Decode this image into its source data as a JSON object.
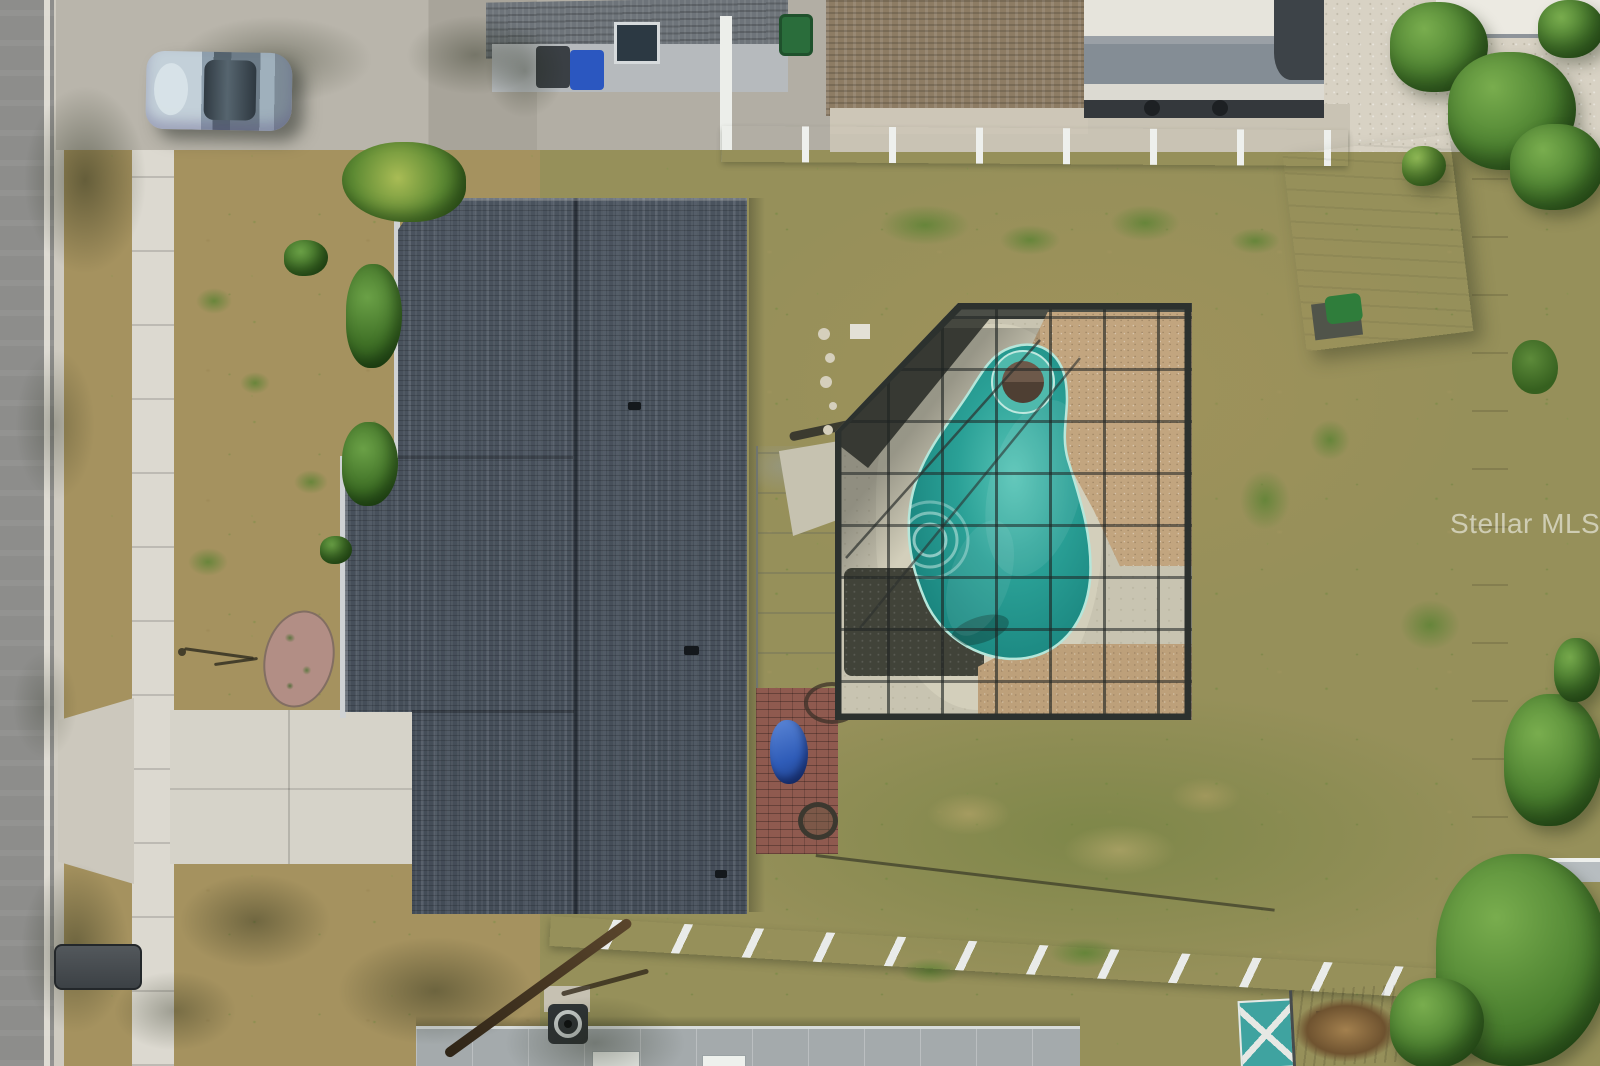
{
  "watermark": {
    "text": "Stellar MLS"
  },
  "palette": {
    "road": "#8d8d8b",
    "sidewalk": "#dcd9d0",
    "driveway": "#d6d3c9",
    "gravel": "#d8d2c4",
    "front_grass": "#a5925f",
    "back_grass": "#96905a",
    "roof_dark": "#47505b",
    "roof_brown": "#8d7c64",
    "lanai": "#e9eae3",
    "brick": "#8f5a4f",
    "tarp": "#2f5cb8",
    "deck": "#c8c4b1",
    "deck_light": "#d3cfbb",
    "pebble": "#c2a57f",
    "lava": "#45473f",
    "cage_frame": "#2c312e",
    "pool_light": "#57c4b6",
    "pool_mid": "#2aa096",
    "pool_deep": "#17807a",
    "spa_cover": "#6d594a",
    "fence_white": "#eceeea",
    "fence_gray": "#aab0b4",
    "shed_gray": "#ccd2ce",
    "shed_teal": "#3fa3a0",
    "tree": "#4c8130",
    "car": "#a9bac7",
    "rv": "#e6e4dc",
    "rv_dark": "#3d4348",
    "mulch": "#b28e85",
    "watermark": "rgba(255,255,255,0.55)"
  },
  "objects": {
    "description": "aerial-view-of-residential-lot",
    "items": [
      "street",
      "sidewalk",
      "driveway",
      "parked-car",
      "main-house-roof",
      "covered-lanai",
      "brick-patio",
      "screened-pool-enclosure",
      "freeform-pool",
      "spa",
      "backyard-lawn",
      "white-pvc-fences",
      "neighbor-house-north",
      "rv-trailer",
      "metal-shed",
      "teal-shed",
      "neighbor-house-south",
      "trees"
    ]
  }
}
